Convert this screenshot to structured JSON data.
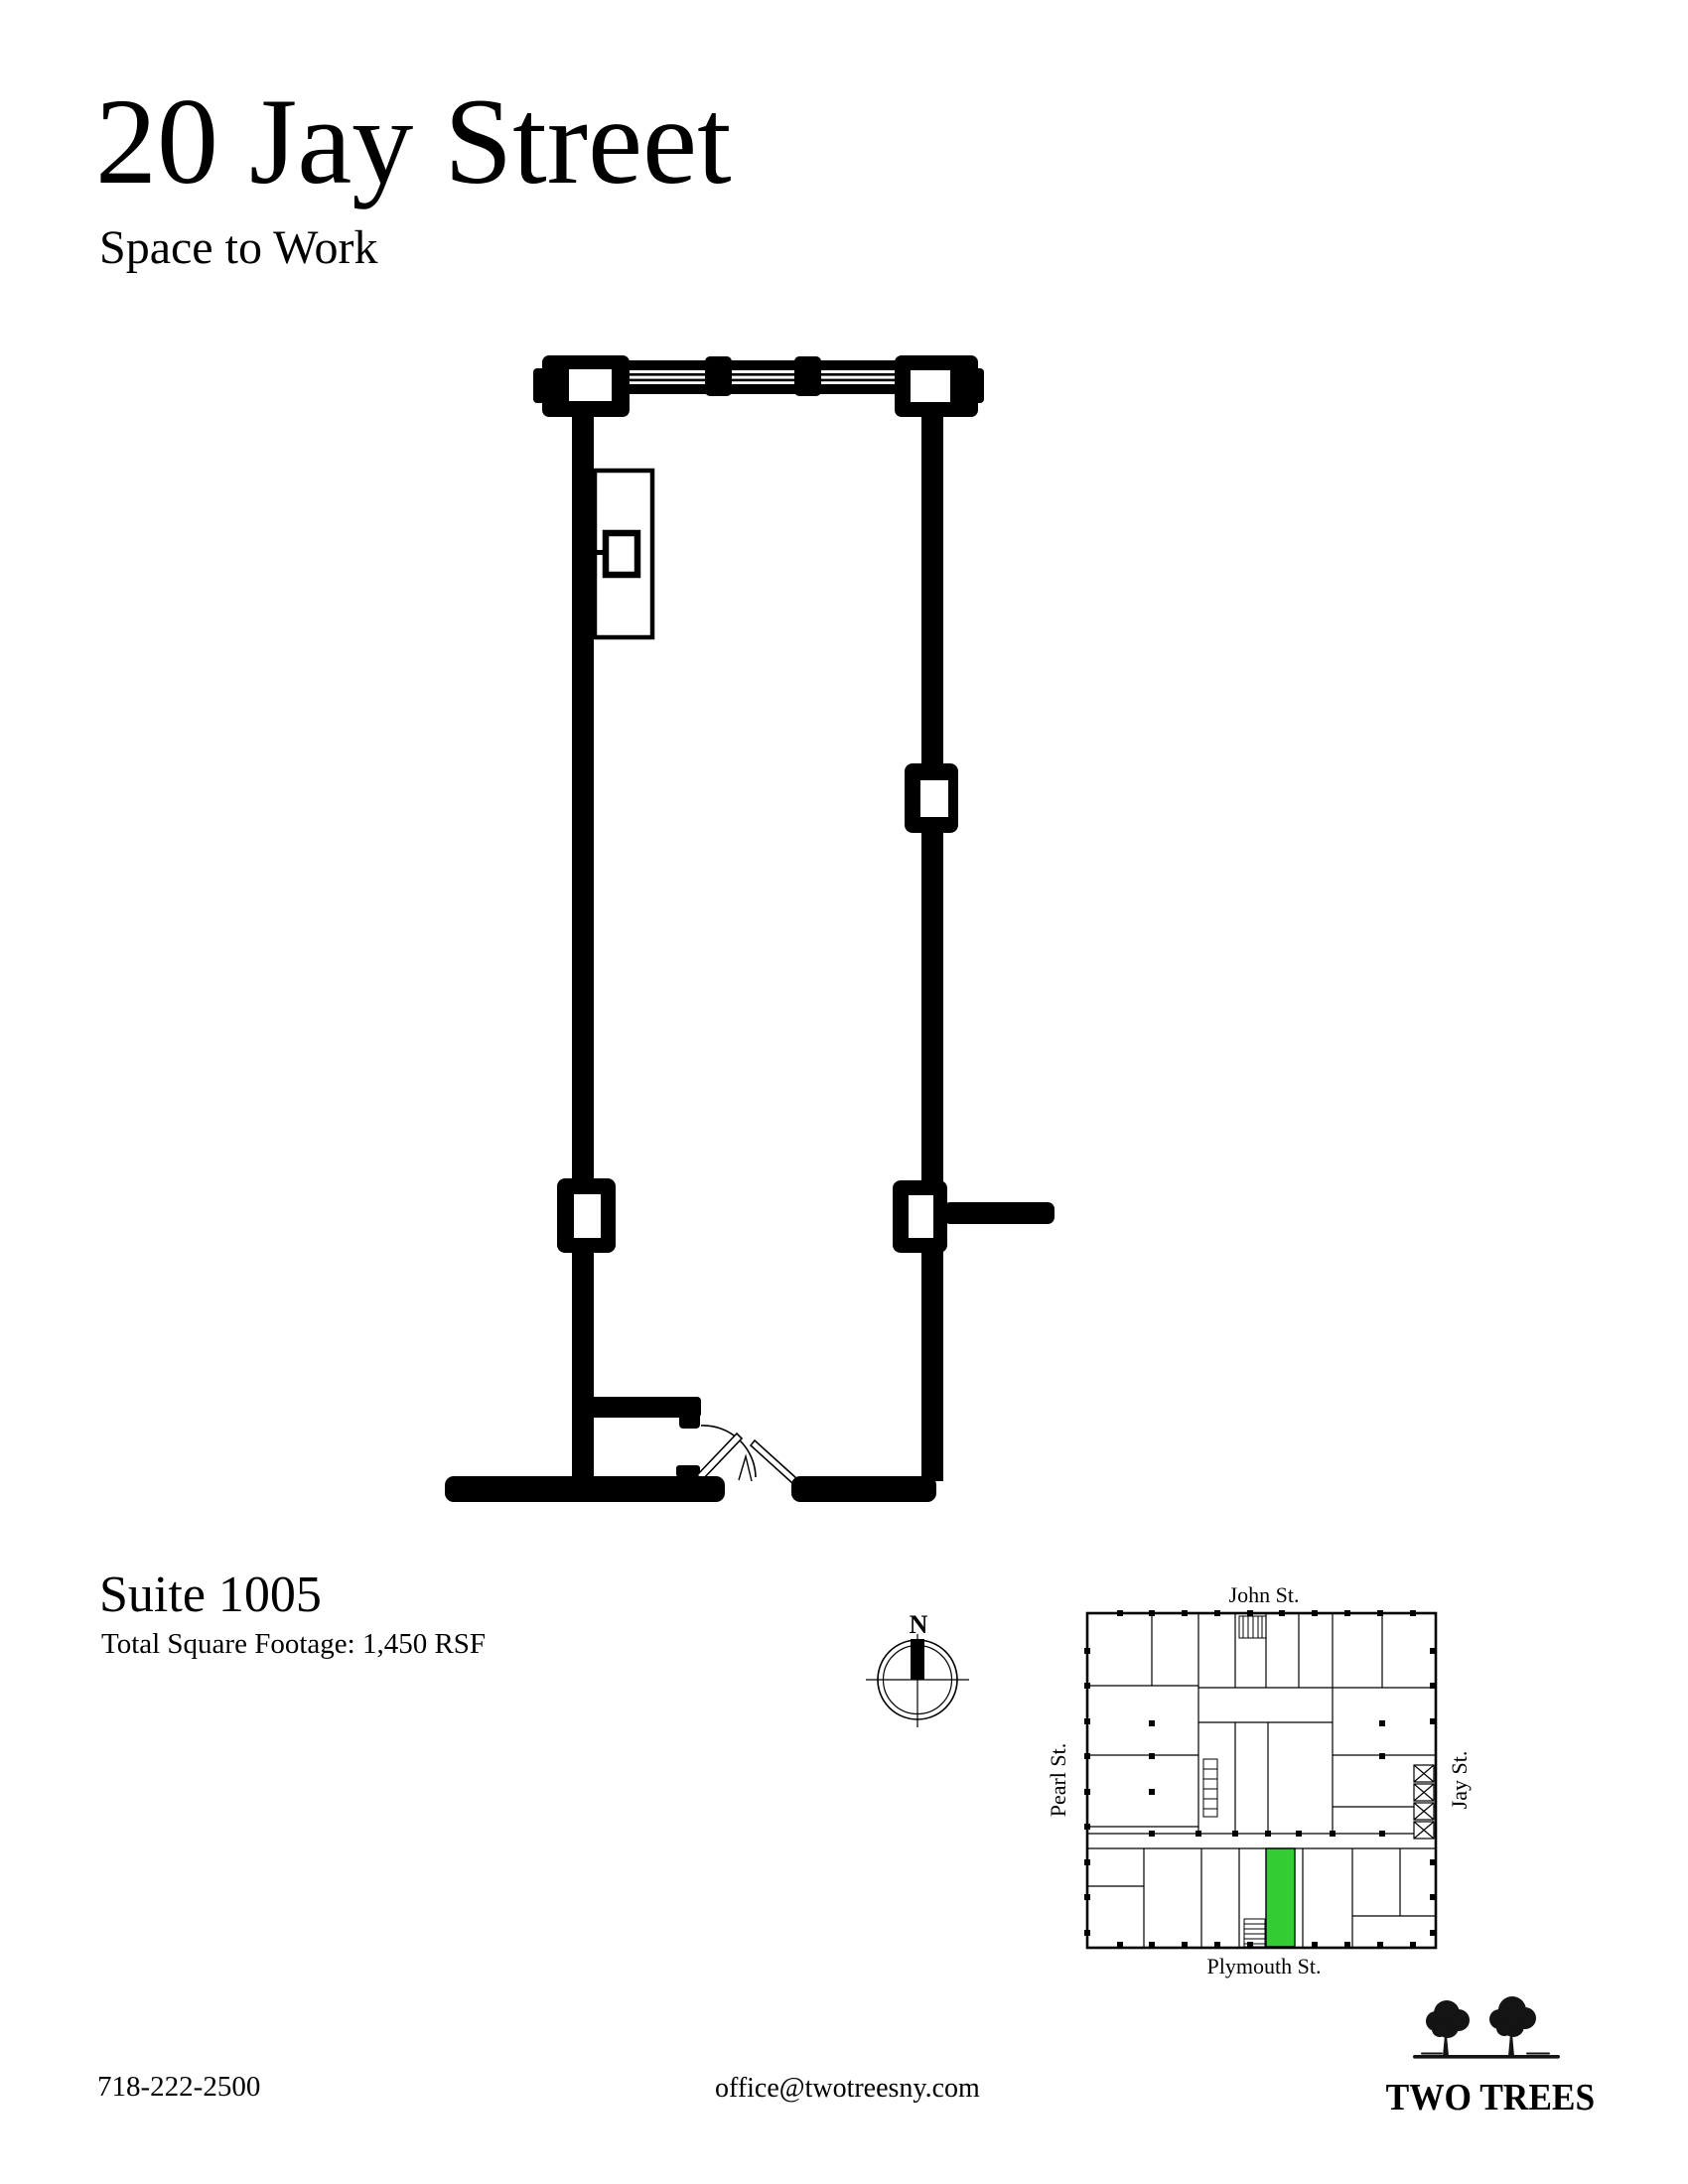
{
  "header": {
    "title": "20 Jay Street",
    "subtitle": "Space to Work"
  },
  "suite": {
    "name": "Suite 1005",
    "footage": "Total Square Footage: 1,450 RSF"
  },
  "compass": {
    "north_label": "N"
  },
  "key_map": {
    "street_top": "John St.",
    "street_left": "Pearl St.",
    "street_right": "Jay St.",
    "street_bottom": "Plymouth St.",
    "highlight_color": "#33cc33"
  },
  "footer": {
    "phone": "718-222-2500",
    "email": "office@twotreesny.com"
  },
  "logo": {
    "name": "TWO TREES"
  },
  "colors": {
    "ink": "#000000",
    "background": "#ffffff",
    "suite_highlight": "#33cc33"
  }
}
